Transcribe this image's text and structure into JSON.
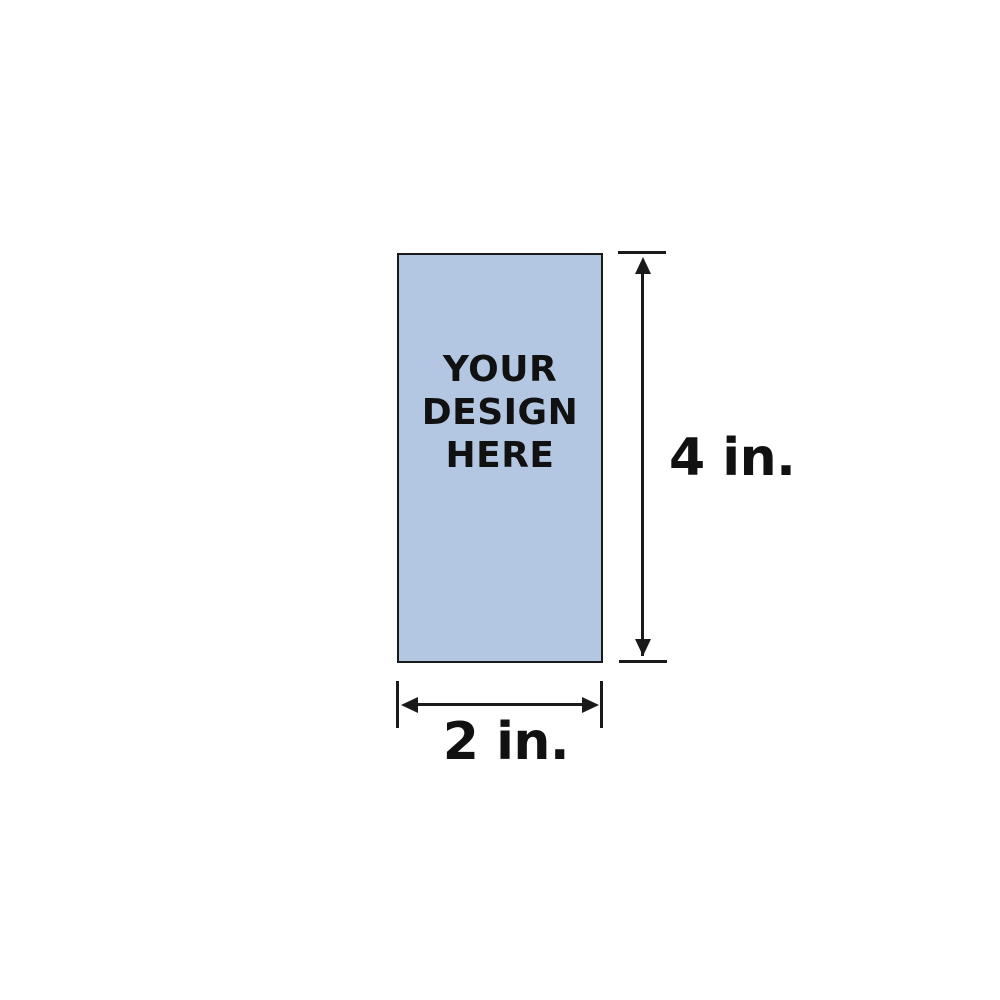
{
  "canvas": {
    "background_color": "#FFFFFF"
  },
  "mockup": {
    "shape": "rectangle",
    "fill_color": "#B3C6E2",
    "border_color": "#1A1A1A",
    "placeholder": {
      "lines": [
        "YOUR",
        "DESIGN",
        "HERE"
      ],
      "text_color": "#111111"
    },
    "dimensions": {
      "height": {
        "label": "4 in.",
        "value": 4,
        "unit": "in"
      },
      "width": {
        "label": "2 in.",
        "value": 2,
        "unit": "in"
      }
    },
    "dimension_line_color": "#1A1A1A"
  }
}
